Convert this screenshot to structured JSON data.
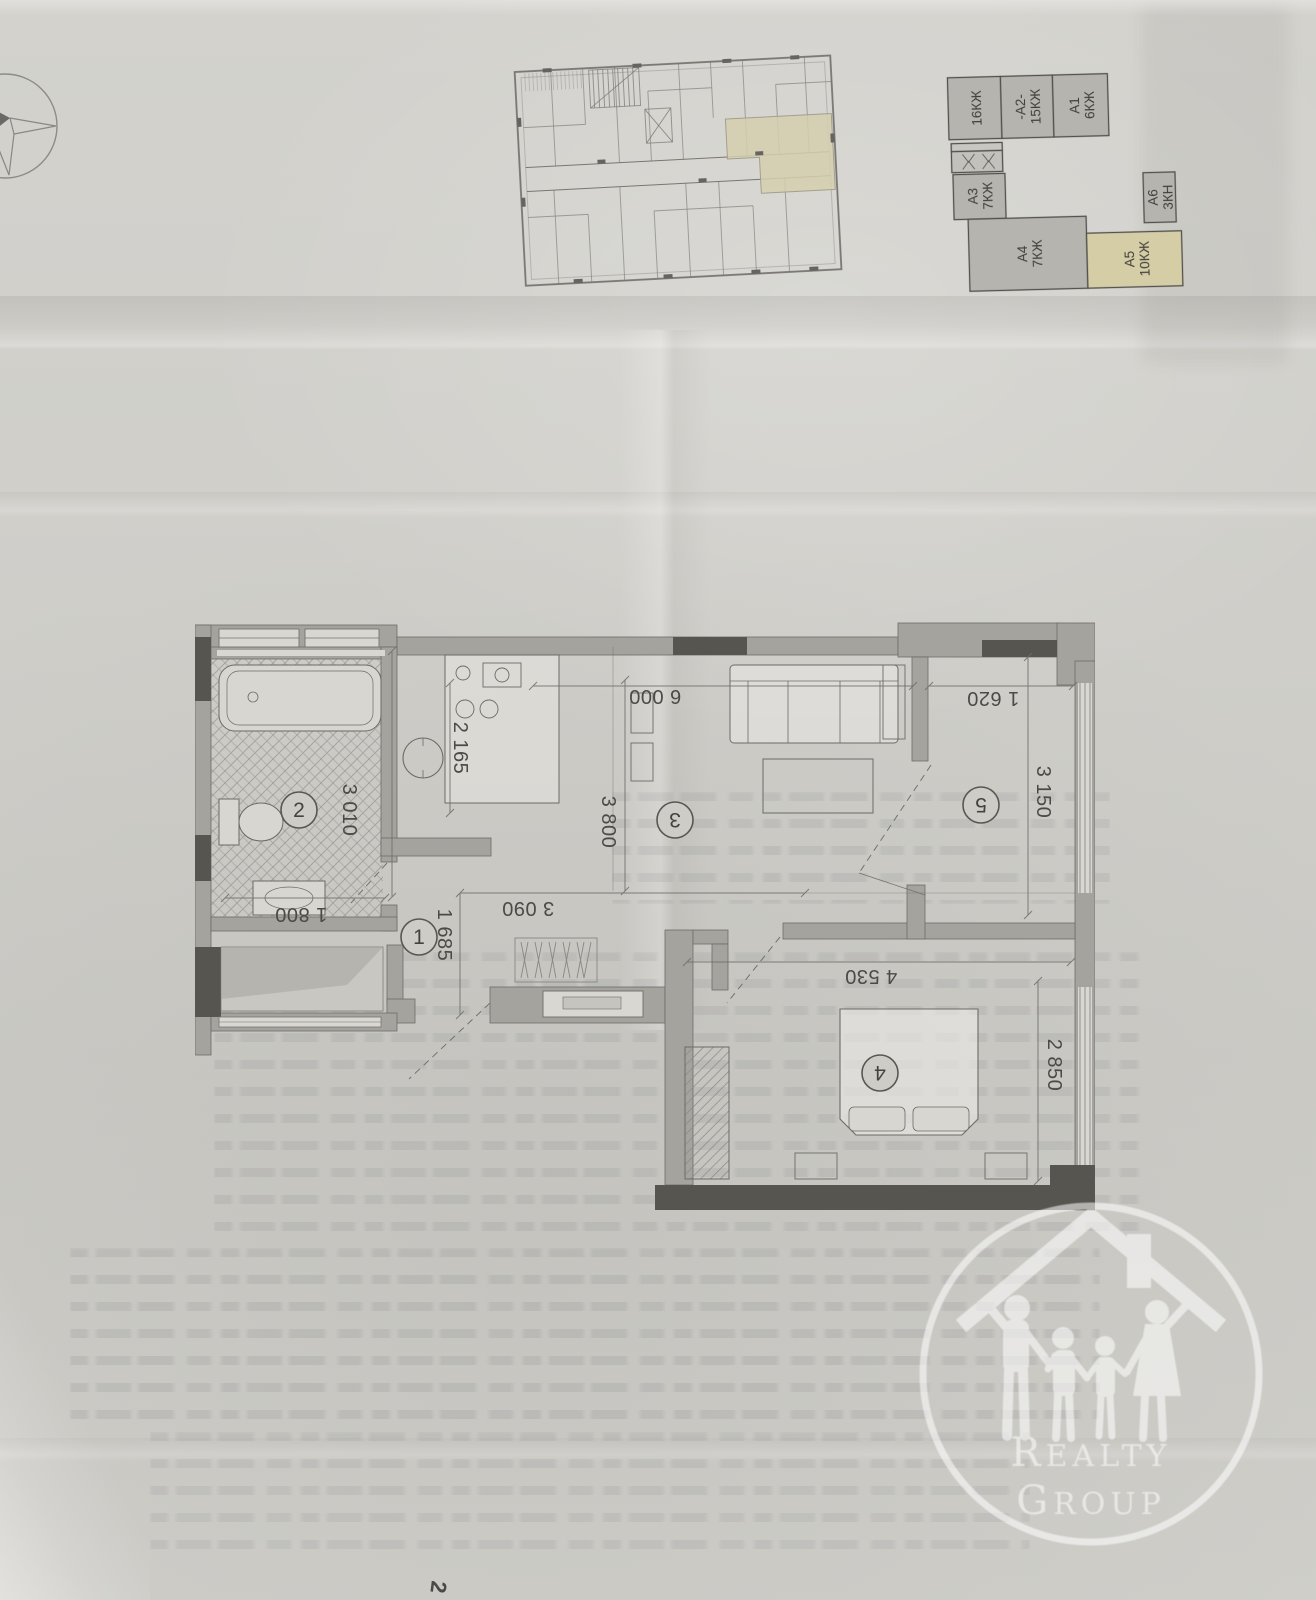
{
  "page": {
    "footer_mark": "2"
  },
  "key_plan": {
    "highlighted_unit": "А5",
    "highlight_color": "#d5cda6",
    "units": [
      {
        "code": "",
        "area": "16КЖ"
      },
      {
        "code": "-А2-",
        "area": "15КЖ"
      },
      {
        "code": "А1",
        "area": "6КЖ"
      },
      {
        "code": "А3",
        "area": "7КЖ"
      },
      {
        "code": "А6",
        "area": "3КН"
      },
      {
        "code": "А4",
        "area": "7КЖ"
      },
      {
        "code": "А5",
        "area": "10КЖ"
      }
    ]
  },
  "floor_plan": {
    "rooms": [
      {
        "number": "1"
      },
      {
        "number": "2"
      },
      {
        "number": "3"
      },
      {
        "number": "4"
      },
      {
        "number": "5"
      }
    ],
    "dimensions_mm": {
      "living_width": "6 000",
      "kitchen_depth": "2 165",
      "bath_length": "3 010",
      "bath_width": "1 800",
      "hall_depth": "1 685",
      "hall_width": "3 090",
      "living_depth": "3 800",
      "room5_width": "1 620",
      "room5_depth": "3 150",
      "bedroom_width": "4 530",
      "bedroom_depth": "2 850"
    }
  },
  "watermark": {
    "line1_initial": "R",
    "line1_rest": "EALTY",
    "line2_initial": "G",
    "line2_rest": "ROUP"
  }
}
